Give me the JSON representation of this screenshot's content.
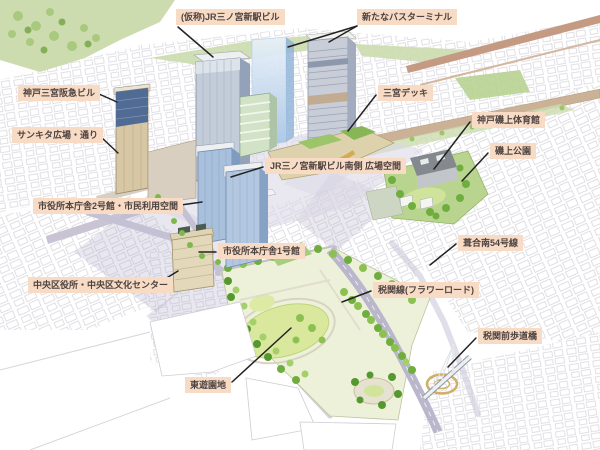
{
  "figure": {
    "kind": "annotated-city-rendering",
    "canvas": {
      "width": 600,
      "height": 450
    }
  },
  "palette": {
    "label_bg": "#f8dbc5",
    "label_text": "#4d4340",
    "leader_line": "#222222",
    "park_green": "#8cc152",
    "lawn_green": "#d9e89c",
    "road_lavender": "#c5c1d4",
    "rail_tan": "#cbb296",
    "glass_blue": "#a9c0dc",
    "building_tan": "#d8c7a5",
    "sketch_line": "#c9c9d2"
  },
  "callouts": [
    {
      "id": "jr-new-station-building",
      "text": "(仮称)JR三ノ宮新駅ビル",
      "x": 176,
      "y": 9,
      "lines": [
        [
          178,
          27,
          213,
          57
        ]
      ]
    },
    {
      "id": "new-bus-terminal",
      "text": "新たなバスターミナル",
      "x": 357,
      "y": 9,
      "lines": [
        [
          357,
          26,
          288,
          47
        ],
        [
          357,
          26,
          329,
          42
        ]
      ]
    },
    {
      "id": "kobe-sannomiya-hankyu-building",
      "text": "神戸三宮阪急ビル",
      "x": 18,
      "y": 85,
      "lines": [
        [
          99,
          94,
          117,
          102
        ]
      ]
    },
    {
      "id": "sunkita-plaza-street",
      "text": "サンキタ広場・通り",
      "x": 12,
      "y": 127,
      "lines": [
        [
          101,
          137,
          118,
          153
        ]
      ]
    },
    {
      "id": "city-hall-annex2-civic-space",
      "text": "市役所本庁舎2号館・市民利用空間",
      "x": 33,
      "y": 198,
      "lines": [
        [
          174,
          206,
          202,
          202
        ]
      ]
    },
    {
      "id": "chuo-ward-office-culture-center",
      "text": "中央区役所・中央区文化センター",
      "x": 28,
      "y": 277,
      "lines": [
        [
          152,
          287,
          178,
          271
        ]
      ]
    },
    {
      "id": "city-hall-no1",
      "text": "市役所本庁舎1号館",
      "x": 218,
      "y": 243,
      "lines": [
        [
          216,
          252,
          199,
          252
        ]
      ]
    },
    {
      "id": "station-south-plaza",
      "text": "JR三ノ宮新駅ビル南側 広場空間",
      "x": 265,
      "y": 158,
      "lines": [
        [
          263,
          167,
          231,
          177
        ]
      ]
    },
    {
      "id": "sannomiya-deck",
      "text": "三宮デッキ",
      "x": 378,
      "y": 85,
      "lines": [
        [
          376,
          95,
          348,
          131
        ]
      ]
    },
    {
      "id": "kobe-isogami-gymnasium",
      "text": "神戸磯上体育館",
      "x": 472,
      "y": 112,
      "lines": [
        [
          470,
          122,
          434,
          169
        ]
      ]
    },
    {
      "id": "isogami-park",
      "text": "磯上公園",
      "x": 490,
      "y": 143,
      "lines": [
        [
          488,
          153,
          462,
          181
        ]
      ]
    },
    {
      "id": "fukiai-minami-route54",
      "text": "葺合南54号線",
      "x": 458,
      "y": 235,
      "lines": [
        [
          456,
          244,
          430,
          265
        ]
      ]
    },
    {
      "id": "zeikan-line-flower-road",
      "text": "税関線(フラワーロード)",
      "x": 373,
      "y": 282,
      "lines": [
        [
          371,
          291,
          342,
          302
        ]
      ]
    },
    {
      "id": "zeikan-mae-pedestrian-bridge",
      "text": "税関前歩道橋",
      "x": 478,
      "y": 328,
      "lines": [
        [
          476,
          338,
          448,
          367
        ]
      ]
    },
    {
      "id": "higashi-yuenchi-park",
      "text": "東遊園地",
      "x": 185,
      "y": 377,
      "lines": [
        [
          232,
          382,
          291,
          328
        ]
      ]
    }
  ]
}
